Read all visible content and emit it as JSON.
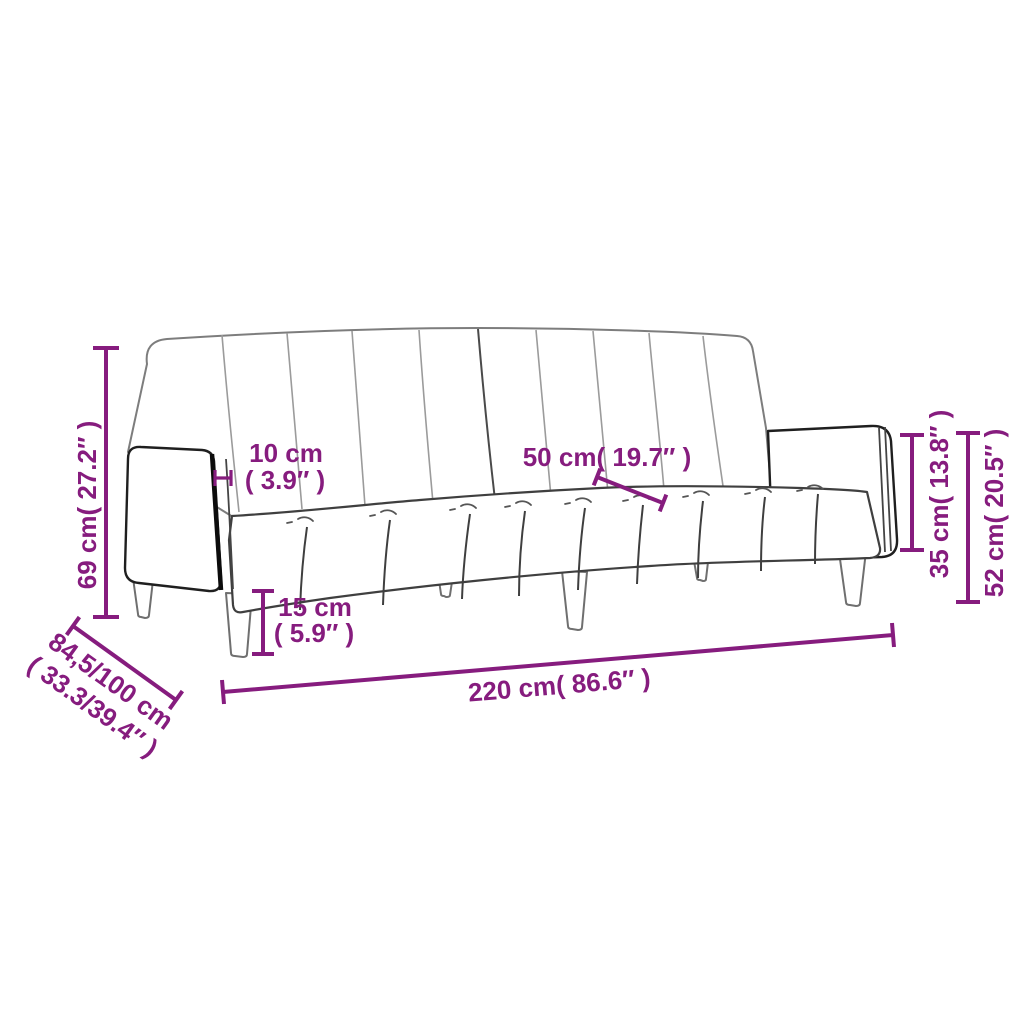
{
  "diagram": {
    "kind": "product-dimension-diagram",
    "subject": "two-seater sofa bed line drawing"
  },
  "colors": {
    "dimension_accent": "#861C7E",
    "outline_dark": "#1f1f1f",
    "outline_gray": "#6f6f6f",
    "outline_light": "#9b9b9b",
    "background": "#ffffff"
  },
  "dims": {
    "h69": {
      "label": "69 cm( 27.2″ )"
    },
    "depth": {
      "line1": "84,5/100 cm",
      "line2": "( 33.3/39.4″ )"
    },
    "w10": {
      "line1": "10 cm",
      "line2": "( 3.9″ )"
    },
    "leg15": {
      "line1": "15 cm",
      "line2": "( 5.9″ )"
    },
    "seat50": {
      "label": "50 cm( 19.7″ )"
    },
    "w220": {
      "label": "220 cm( 86.6″ )"
    },
    "h35": {
      "label": "35 cm( 13.8″ )"
    },
    "h52": {
      "label": "52 cm( 20.5″ )"
    }
  }
}
